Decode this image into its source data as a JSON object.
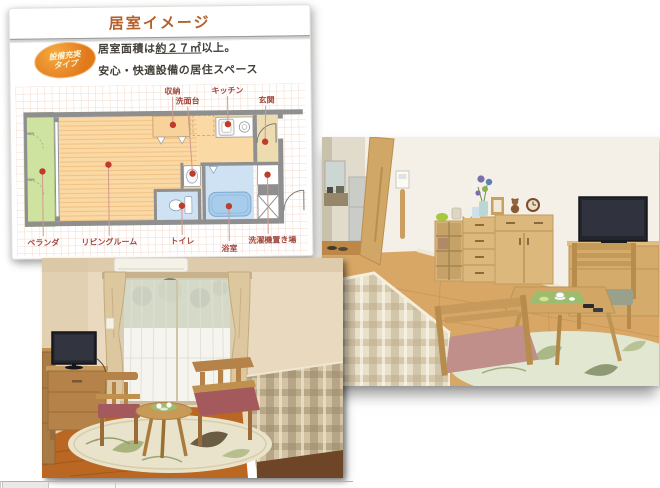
{
  "plan_panel": {
    "title": "居室イメージ",
    "badge": {
      "line1": "設備充実",
      "line2": "タイプ"
    },
    "description": {
      "line1_prefix": "居室面積は",
      "line1_underline": "約２７㎡",
      "line1_suffix": "以上。",
      "line2": "安心・快適設備の居住スペース"
    },
    "floor_plan": {
      "labels": {
        "storage": "収納",
        "washstand": "洗面台",
        "kitchen": "キッチン",
        "entrance": "玄関",
        "veranda": "ベランダ",
        "living_room": "リビングルーム",
        "toilet": "トイレ",
        "bathroom": "浴室",
        "laundry": "洗濯機置き場"
      },
      "colors": {
        "living_floor": "#fbd9a4",
        "veranda": "#cfe3a0",
        "wet_rooms": "#cfe2f3",
        "bathtub": "#a8cdec",
        "entrance": "#eddcb0",
        "walls": "#8f8f8f",
        "marker_dot": "#c23a28",
        "label_text": "#a3493f"
      }
    },
    "accent_color": "#b5602b",
    "badge_color": "#e98b1f"
  },
  "photos": {
    "top_right": {
      "description": "居室写真：木製チェスト・テレビ・ティーテーブルのあるリビング"
    },
    "bottom_left": {
      "description": "居室写真：窓・カーテン・テレビ・ベッドのある居室"
    }
  }
}
